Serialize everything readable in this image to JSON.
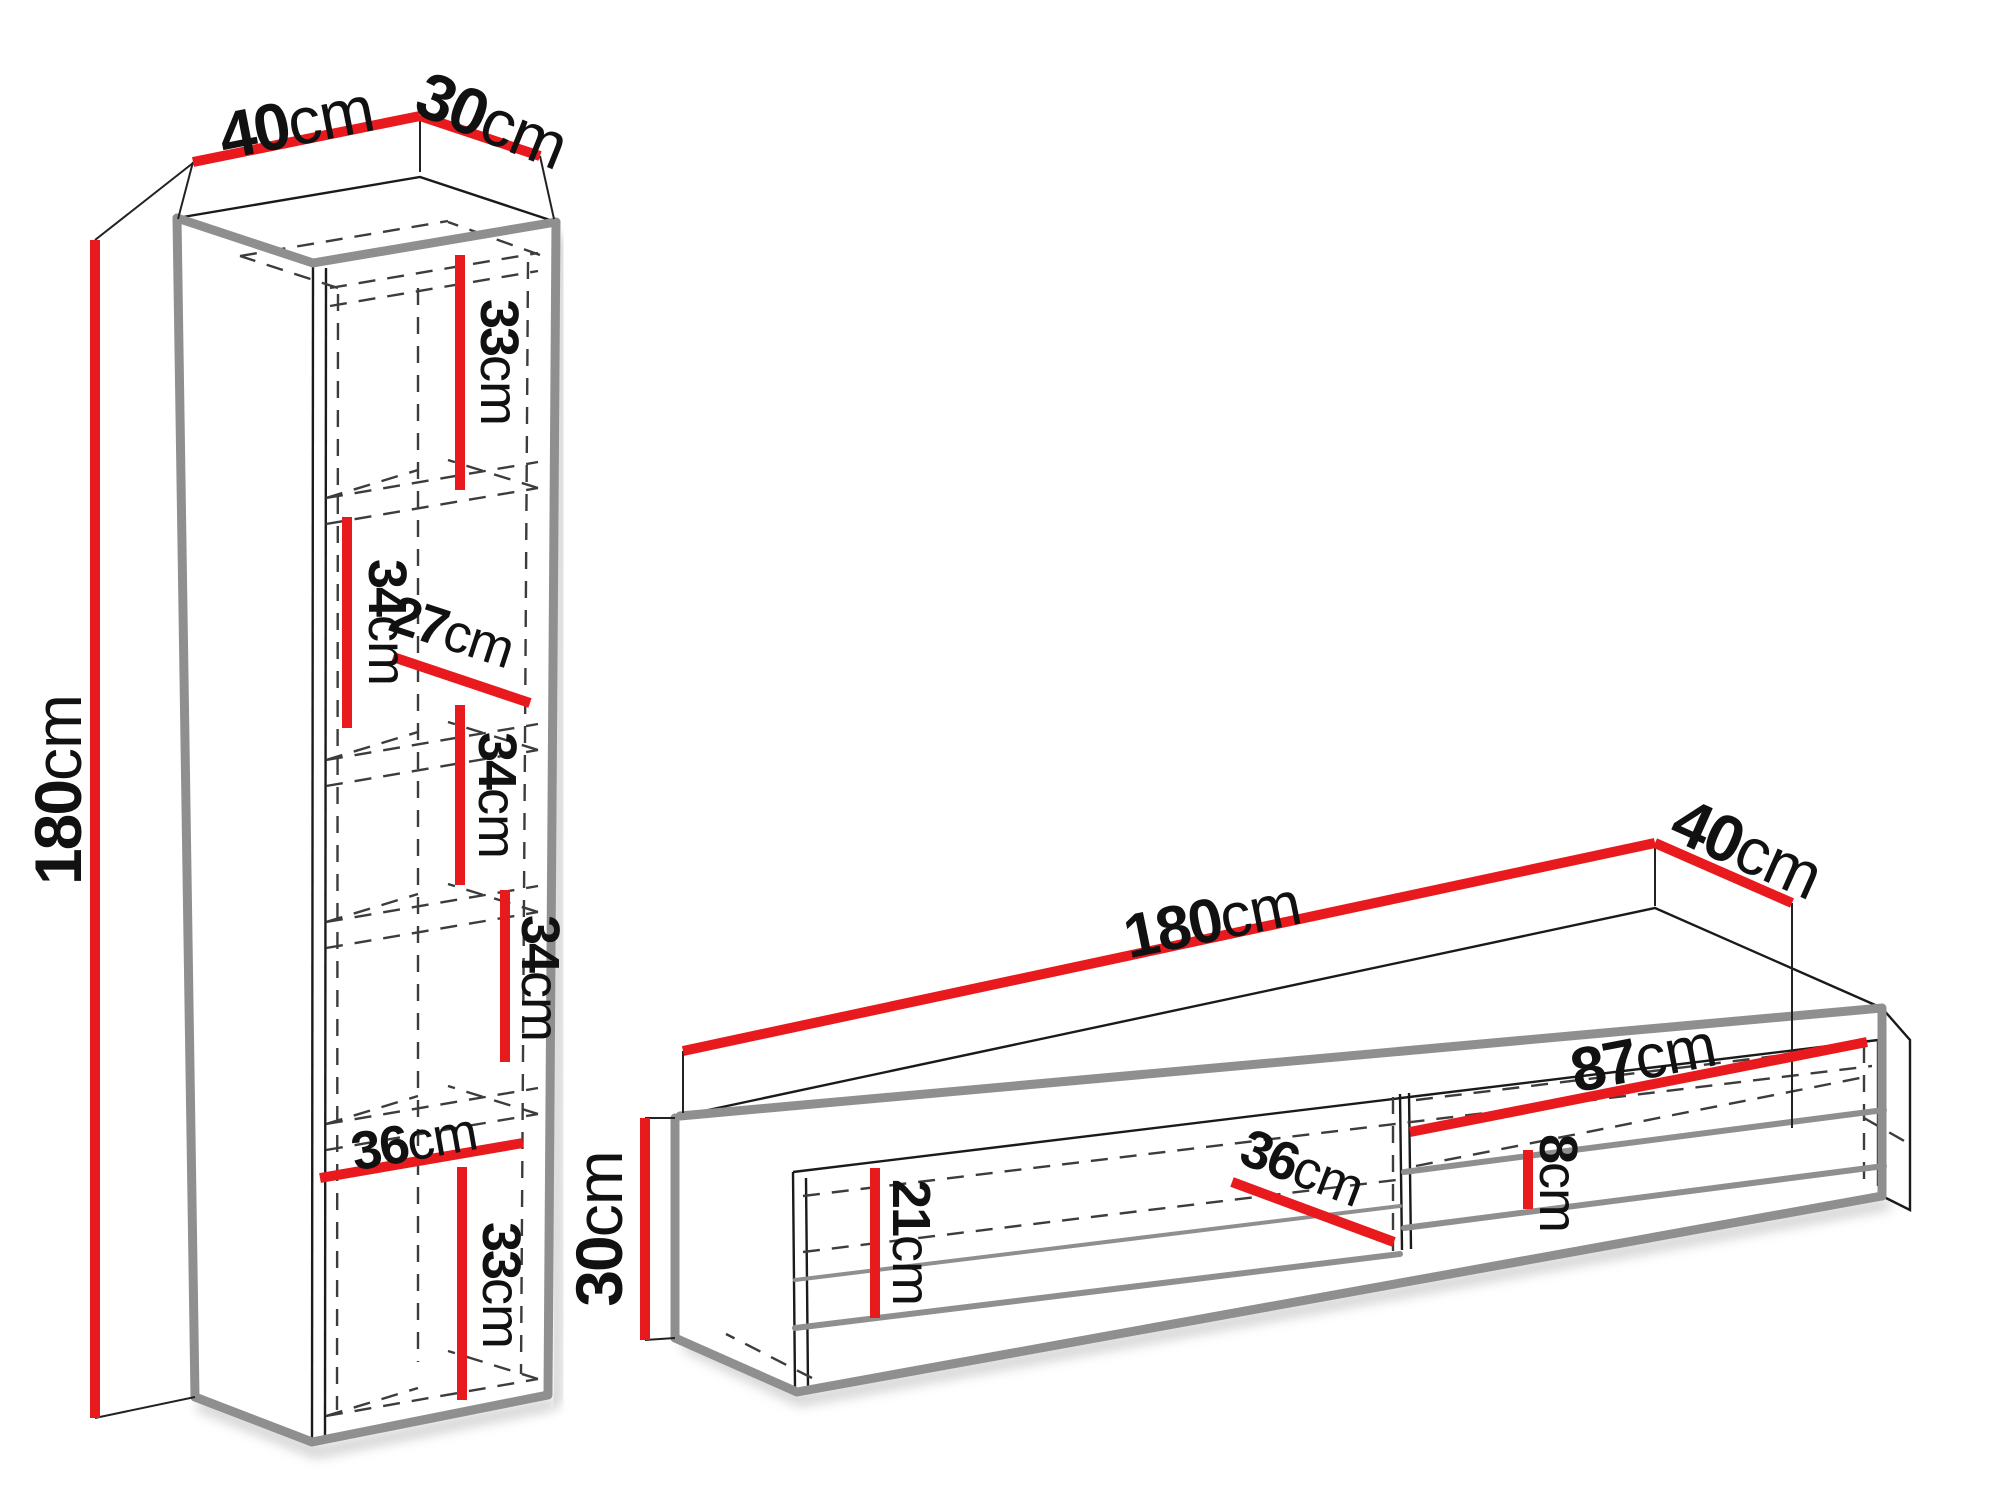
{
  "colors": {
    "dimension_line": "#e81a1d",
    "edge": "#8f8f8f",
    "outline": "#1a1a1a"
  },
  "cabinet": {
    "label": "wall-cabinet",
    "height": {
      "value": "180",
      "unit": "cm"
    },
    "width": {
      "value": "40",
      "unit": "cm"
    },
    "depth": {
      "value": "30",
      "unit": "cm"
    },
    "interior": [
      {
        "value": "33",
        "unit": "cm"
      },
      {
        "value": "34",
        "unit": "cm"
      },
      {
        "value": "27",
        "unit": "cm"
      },
      {
        "value": "34",
        "unit": "cm"
      },
      {
        "value": "34",
        "unit": "cm"
      },
      {
        "value": "36",
        "unit": "cm"
      },
      {
        "value": "33",
        "unit": "cm"
      }
    ]
  },
  "tv_stand": {
    "label": "tv-stand",
    "width": {
      "value": "180",
      "unit": "cm"
    },
    "depth": {
      "value": "40",
      "unit": "cm"
    },
    "height": {
      "value": "30",
      "unit": "cm"
    },
    "interior": [
      {
        "value": "21",
        "unit": "cm"
      },
      {
        "value": "36",
        "unit": "cm"
      },
      {
        "value": "87",
        "unit": "cm"
      },
      {
        "value": "8",
        "unit": "cm"
      }
    ]
  }
}
